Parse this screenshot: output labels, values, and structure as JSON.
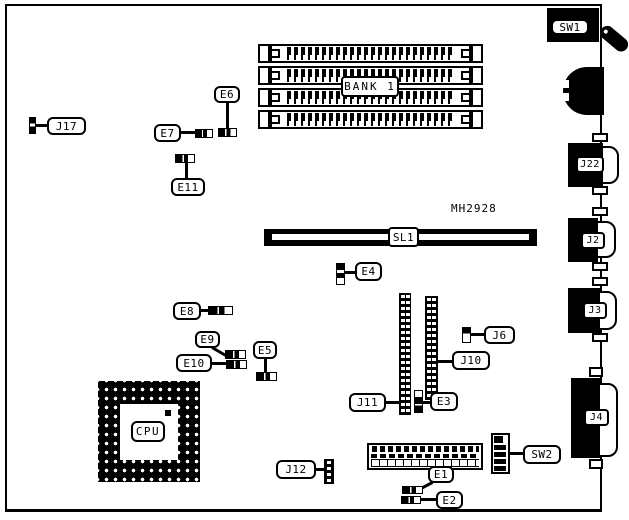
{
  "diagram": {
    "part_number": "MH2928",
    "labels": {
      "sw1": "SW1",
      "sw2": "SW2",
      "j2": "J2",
      "j3": "J3",
      "j4": "J4",
      "j6": "J6",
      "j10": "J10",
      "j11": "J11",
      "j12": "J12",
      "j17": "J17",
      "j22": "J22",
      "e1": "E1",
      "e2": "E2",
      "e3": "E3",
      "e4": "E4",
      "e5": "E5",
      "e6": "E6",
      "e7": "E7",
      "e8": "E8",
      "e9": "E9",
      "e10": "E10",
      "e11": "E11",
      "bank1": "BANK 1",
      "sl1": "SL1",
      "cpu": "CPU"
    },
    "colors": {
      "ink": "#000000",
      "paper": "#ffffff"
    }
  }
}
